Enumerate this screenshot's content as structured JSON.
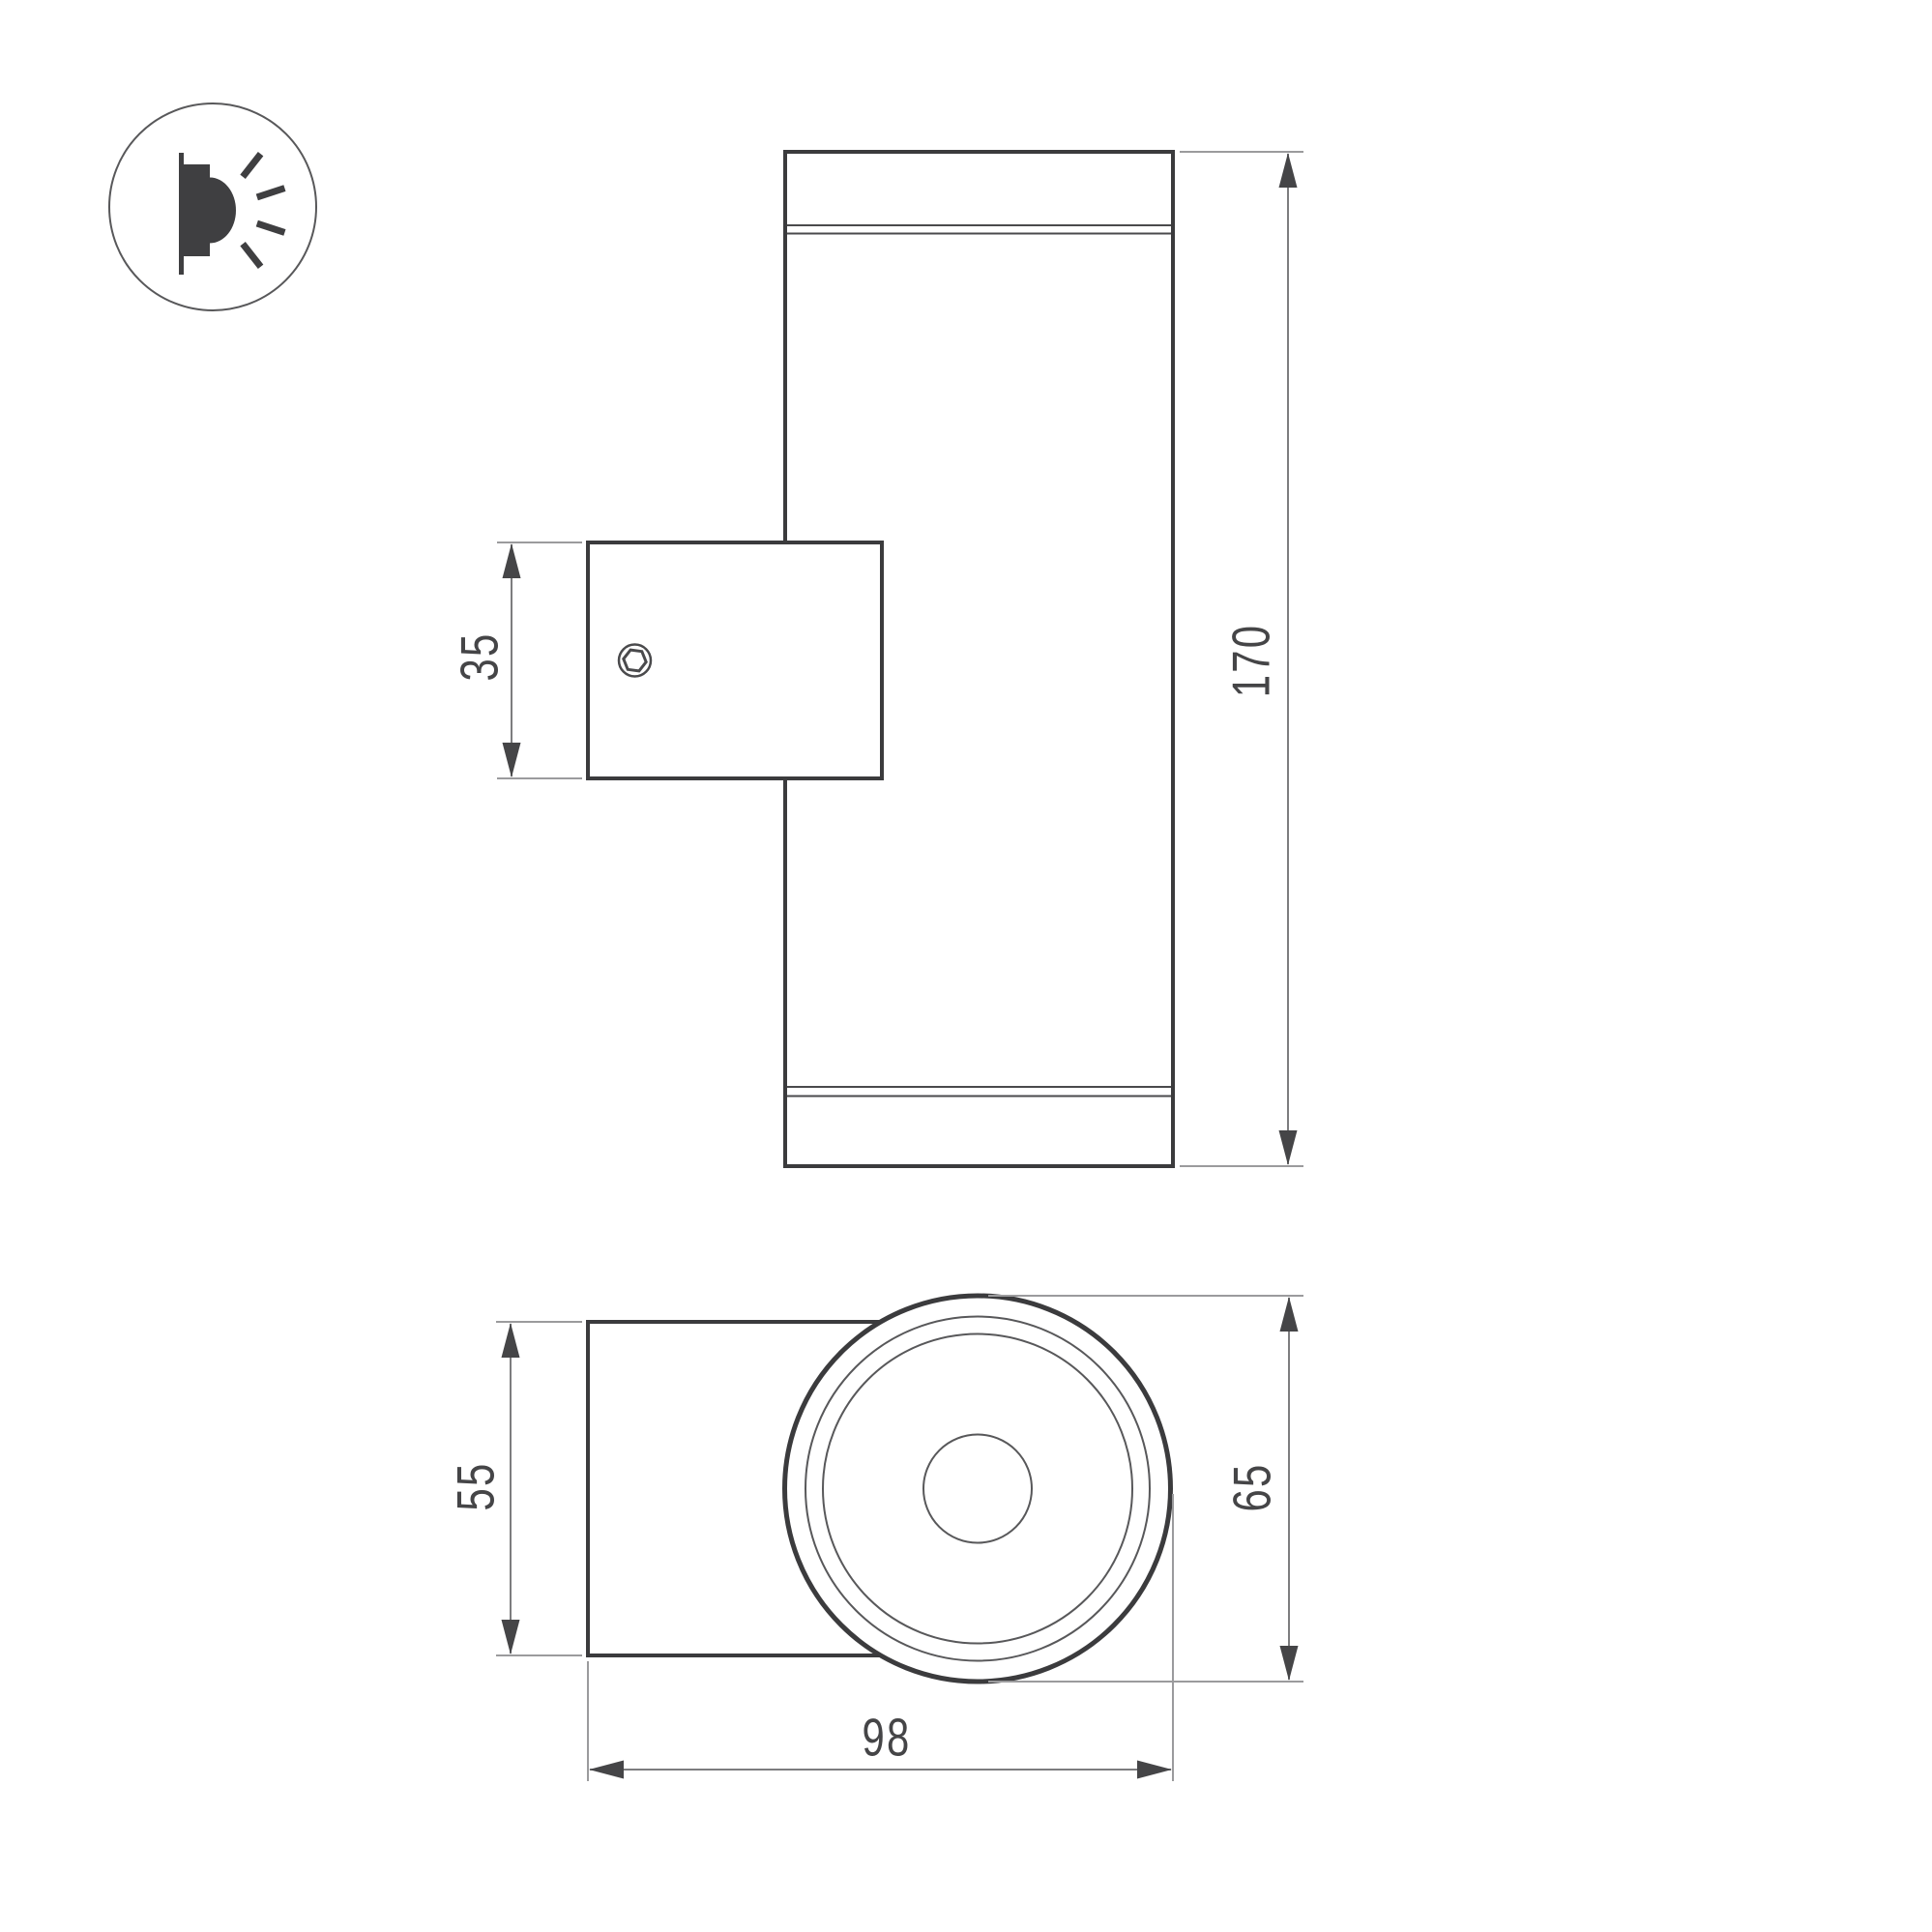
{
  "drawing": {
    "type": "technical-dimension-drawing",
    "product": "cylindrical wall-mounted luminaire",
    "views": {
      "front_view": "cylinder body with wall-mount bracket and hex set screw",
      "top_view": "mount box and round body with concentric rings"
    },
    "icon": {
      "name": "wall-light-emission-icon",
      "meaning": "light emitted sideways from wall-mounted fixture"
    },
    "dimensions": {
      "bracket_height": "35",
      "body_height": "170",
      "mount_width": "55",
      "body_diameter": "65",
      "total_depth": "98"
    },
    "colors": {
      "background": "#ffffff",
      "outline_bold": "#3b3b3d",
      "outline_thin": "#58585a",
      "dimension_line": "#7d7d7f",
      "arrow": "#454547",
      "text": "#454547",
      "icon_fill": "#3f3f41"
    }
  }
}
